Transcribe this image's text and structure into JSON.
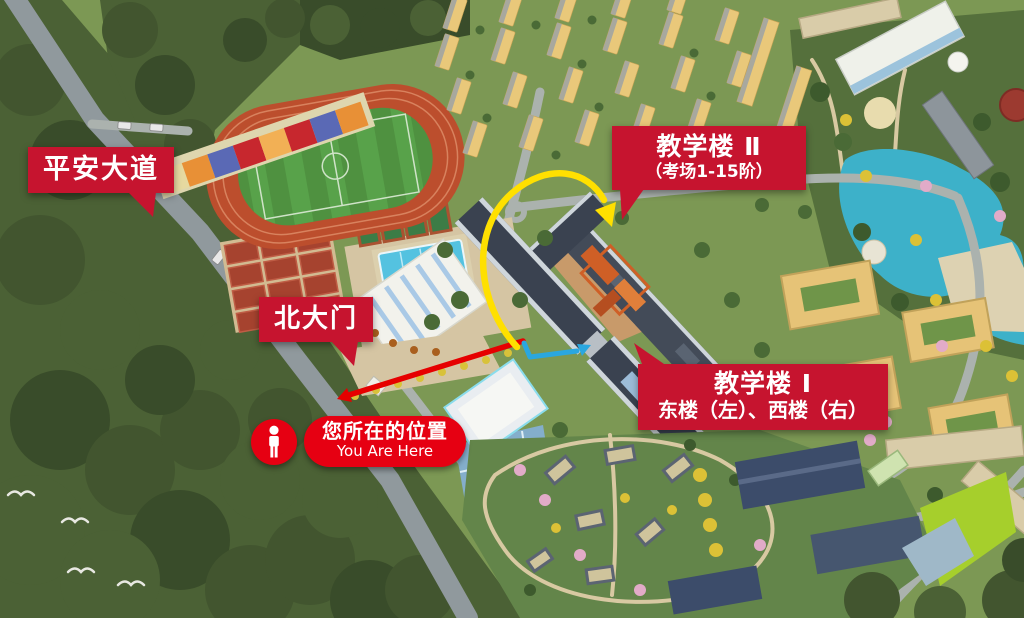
{
  "map": {
    "labels": {
      "avenue": "平安大道",
      "north_gate": "北大门",
      "building2_title": "教学楼 Ⅱ",
      "building2_sub": "（考场1-15阶）",
      "building1_title": "教学楼 Ⅰ",
      "building1_sub": "东楼（左）、西楼（右）",
      "you_are_here_cn": "您所在的位置",
      "you_are_here_en": "You Are Here"
    },
    "colors": {
      "label_red": "#c6142f",
      "marker_red": "#e60012",
      "route_to_building2": "#ffe000",
      "route_to_building1": "#2aa7e0",
      "route_main_road": "#e60000"
    },
    "icons": {
      "person_marker": "person-icon"
    }
  }
}
